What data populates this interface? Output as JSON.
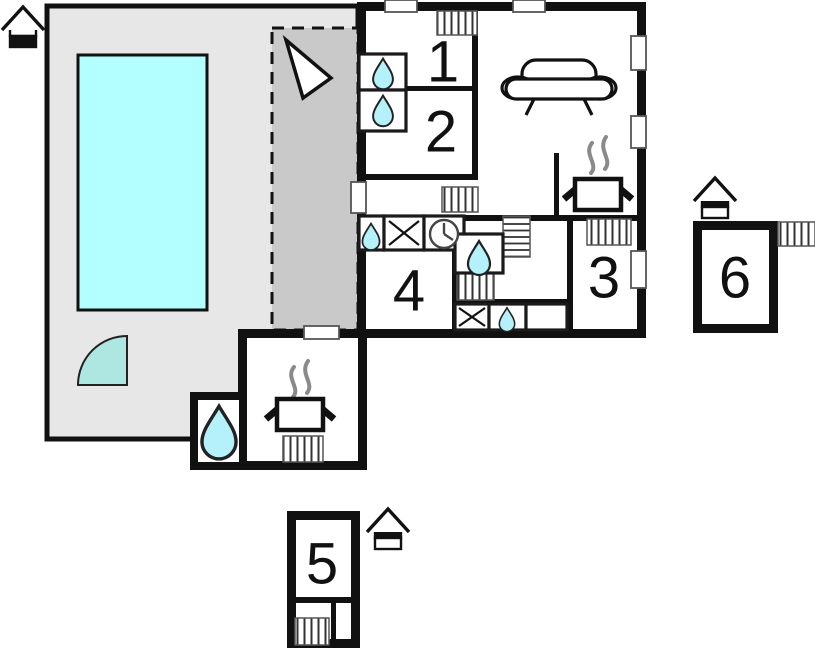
{
  "plan": {
    "type": "floor-plan",
    "rooms": [
      {
        "id": "room-1",
        "label": "1"
      },
      {
        "id": "room-2",
        "label": "2"
      },
      {
        "id": "room-3",
        "label": "3"
      },
      {
        "id": "room-4",
        "label": "4"
      },
      {
        "id": "room-5",
        "label": "5"
      },
      {
        "id": "room-6",
        "label": "6"
      }
    ],
    "colors": {
      "wall": "#111111",
      "patio": "#e7e7e7",
      "terrace": "#c9c9c9",
      "pool": "#b3ffff",
      "door_arc": "#aee6e2",
      "water": "#b5f1fb",
      "steam": "#8a8a8a",
      "background": "#ffffff"
    },
    "icons": {
      "house": "svg-house-pictogram",
      "north_arrow": "svg-triangle-arrow",
      "sink_drop": "svg-teardrop",
      "washing_machine": "svg-x-box",
      "clock": "svg-clock-face",
      "stairs": "svg-horizontal-hatch",
      "radiator": "svg-vertical-hatch",
      "sofa": "svg-sofa",
      "stove": "svg-pot-with-steam",
      "door_swing": "svg-quarter-circle",
      "pool": "svg-cyan-rect"
    }
  }
}
